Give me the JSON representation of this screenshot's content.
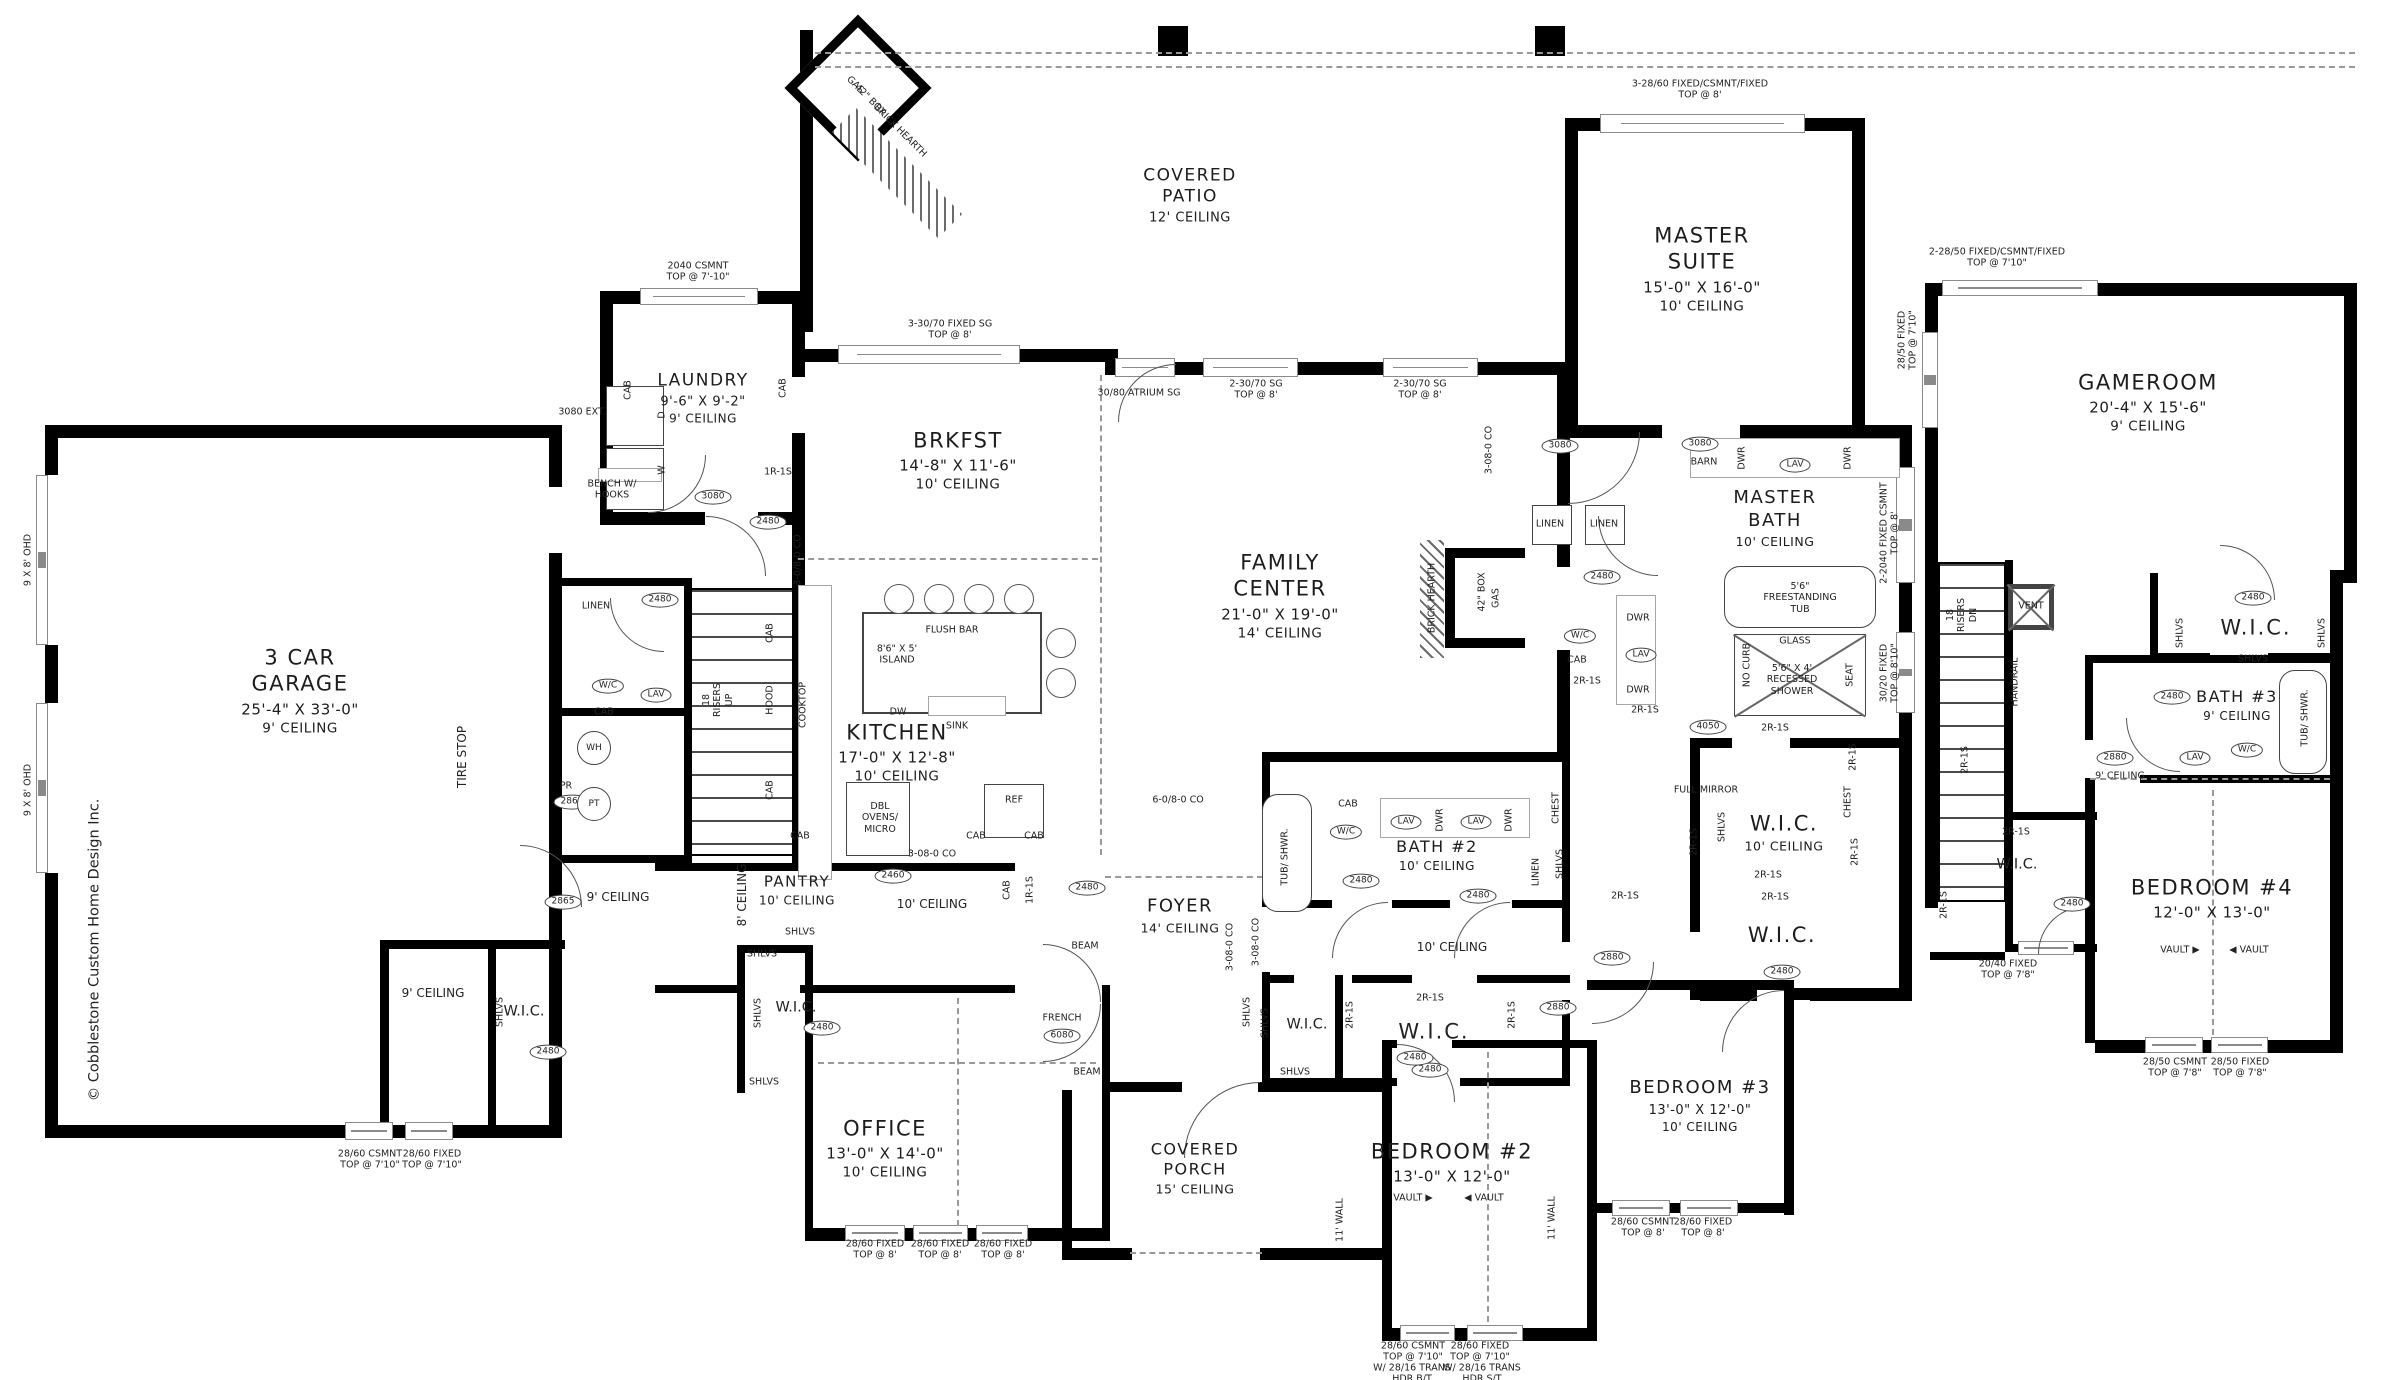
{
  "rooms": {
    "garage": {
      "name": "3 CAR\nGARAGE",
      "dims": "25'-4\" X 33'-0\"",
      "ceiling": "9' CEILING"
    },
    "laundry": {
      "name": "LAUNDRY",
      "dims": "9'-6\" X 9'-2\"",
      "ceiling": "9' CEILING"
    },
    "brkfst": {
      "name": "BRKFST",
      "dims": "14'-8\" X 11'-6\"",
      "ceiling": "10' CEILING"
    },
    "kitchen": {
      "name": "KITCHEN",
      "dims": "17'-0\" X 12'-8\"",
      "ceiling": "10' CEILING"
    },
    "family": {
      "name": "FAMILY\nCENTER",
      "dims": "21'-0\" X 19'-0\"",
      "ceiling": "14' CEILING"
    },
    "patio": {
      "name": "COVERED\nPATIO",
      "dims": "",
      "ceiling": "12' CEILING"
    },
    "master": {
      "name": "MASTER\nSUITE",
      "dims": "15'-0\" X 16'-0\"",
      "ceiling": "10' CEILING"
    },
    "masterbath": {
      "name": "MASTER\nBATH",
      "dims": "",
      "ceiling": "10' CEILING"
    },
    "masterwic": {
      "name": "W.I.C.",
      "dims": "",
      "ceiling": "10' CEILING"
    },
    "masterwic2": {
      "name": "W.I.C.",
      "dims": "",
      "ceiling": ""
    },
    "office": {
      "name": "OFFICE",
      "dims": "13'-0\" X 14'-0\"",
      "ceiling": "10' CEILING"
    },
    "foyer": {
      "name": "FOYER",
      "dims": "",
      "ceiling": "14' CEILING"
    },
    "porch": {
      "name": "COVERED\nPORCH",
      "dims": "",
      "ceiling": "15' CEILING"
    },
    "pantry": {
      "name": "PANTRY",
      "dims": "",
      "ceiling": "10' CEILING"
    },
    "bath2": {
      "name": "BATH #2",
      "dims": "",
      "ceiling": "10' CEILING"
    },
    "bed2": {
      "name": "BEDROOM #2",
      "dims": "13'-0\" X 12'-0\"",
      "ceiling": ""
    },
    "bed3": {
      "name": "BEDROOM #3",
      "dims": "13'-0\" X 12'-0\"",
      "ceiling": "10' CEILING"
    },
    "gameroom": {
      "name": "GAMEROOM",
      "dims": "20'-4\" X 15'-6\"",
      "ceiling": "9' CEILING"
    },
    "bath3": {
      "name": "BATH #3",
      "dims": "",
      "ceiling": "9' CEILING"
    },
    "bed4": {
      "name": "BEDROOM #4",
      "dims": "12'-0\" X 13'-0\"",
      "ceiling": ""
    }
  },
  "annotations": [
    {
      "t": "TIRE STOP",
      "x": 462,
      "y": 757,
      "r": -90,
      "c": "sm"
    },
    {
      "t": "© Cobblestone Custom Home Design Inc.",
      "x": 95,
      "y": 950,
      "r": -90,
      "c": "md"
    },
    {
      "t": "9 X 8' OHD",
      "x": 28,
      "y": 560,
      "r": -90
    },
    {
      "t": "9 X 8' OHD",
      "x": 28,
      "y": 790,
      "r": -90
    },
    {
      "t": "3080 EXT.",
      "x": 582,
      "y": 412
    },
    {
      "t": "2040 CSMNT\nTOP @ 7'-10\"",
      "x": 698,
      "y": 272
    },
    {
      "t": "3-30/70 FIXED SG\nTOP @ 8'",
      "x": 950,
      "y": 330
    },
    {
      "t": "30/80 ATRIUM SG",
      "x": 1139,
      "y": 393
    },
    {
      "t": "2-30/70 SG\nTOP @ 8'",
      "x": 1256,
      "y": 390
    },
    {
      "t": "2-30/70 SG\nTOP @ 8'",
      "x": 1420,
      "y": 390
    },
    {
      "t": "3-28/60 FIXED/CSMNT/FIXED\nTOP @ 8'",
      "x": 1700,
      "y": 90
    },
    {
      "t": "2-2040 FIXED CSMNT\nTOP @ 8'",
      "x": 1890,
      "y": 533,
      "r": -90
    },
    {
      "t": "30/20 FIXED\nTOP @ 8'10\"",
      "x": 1890,
      "y": 673,
      "r": -90
    },
    {
      "t": "2-28/50 FIXED/CSMNT/FIXED\nTOP @ 7'10\"",
      "x": 1997,
      "y": 258
    },
    {
      "t": "28/50 FIXED\nTOP @ 7'10\"",
      "x": 1908,
      "y": 340,
      "r": -90
    },
    {
      "t": "28/60 FIXED\nTOP @ 8'",
      "x": 875,
      "y": 1250
    },
    {
      "t": "28/60 FIXED\nTOP @ 8'",
      "x": 940,
      "y": 1250
    },
    {
      "t": "28/60 FIXED\nTOP @ 8'",
      "x": 1003,
      "y": 1250
    },
    {
      "t": "28/60 CSMNT\nTOP @ 7'10\"",
      "x": 370,
      "y": 1160
    },
    {
      "t": "28/60 FIXED\nTOP @ 7'10\"",
      "x": 432,
      "y": 1160
    },
    {
      "t": "28/60 CSMNT\nTOP @ 7'10\"",
      "x": 1413,
      "y": 1352
    },
    {
      "t": "28/60 FIXED\nTOP @ 7'10\"",
      "x": 1480,
      "y": 1352
    },
    {
      "t": "W/ 28/16 TRANS\nHDR B/T",
      "x": 1412,
      "y": 1374
    },
    {
      "t": "W/ 28/16 TRANS\nHDR S/T",
      "x": 1482,
      "y": 1374
    },
    {
      "t": "28/60 CSMNT\nTOP @ 8'",
      "x": 1643,
      "y": 1228
    },
    {
      "t": "28/60 FIXED\nTOP @ 8'",
      "x": 1703,
      "y": 1228
    },
    {
      "t": "28/50 CSMNT\nTOP @ 7'8\"",
      "x": 2175,
      "y": 1068
    },
    {
      "t": "28/50 FIXED\nTOP @ 7'8\"",
      "x": 2240,
      "y": 1068
    },
    {
      "t": "20/40 FIXED\nTOP @ 7'8\"",
      "x": 2008,
      "y": 970
    },
    {
      "t": "BENCH W/\nHOOKS",
      "x": 612,
      "y": 490
    },
    {
      "t": "1R-1S",
      "x": 778,
      "y": 472
    },
    {
      "t": "CAB",
      "x": 628,
      "y": 390,
      "r": -90
    },
    {
      "t": "CAB",
      "x": 783,
      "y": 388,
      "r": -90
    },
    {
      "t": "D",
      "x": 662,
      "y": 415,
      "r": -90
    },
    {
      "t": "W",
      "x": 662,
      "y": 470,
      "r": -90
    },
    {
      "t": "3-0/8-0 CO",
      "x": 798,
      "y": 560,
      "r": -90
    },
    {
      "t": "3080",
      "x": 713,
      "y": 497,
      "c": "ov"
    },
    {
      "t": "2480",
      "x": 768,
      "y": 522,
      "c": "ov"
    },
    {
      "t": "LINEN",
      "x": 596,
      "y": 606
    },
    {
      "t": "W/C",
      "x": 608,
      "y": 686,
      "c": "ov"
    },
    {
      "t": "LAV",
      "x": 656,
      "y": 695,
      "c": "ov"
    },
    {
      "t": "CAB",
      "x": 604,
      "y": 712
    },
    {
      "t": "2480",
      "x": 660,
      "y": 600,
      "c": "ov"
    },
    {
      "t": "PR",
      "x": 566,
      "y": 786
    },
    {
      "t": "2865",
      "x": 572,
      "y": 802,
      "c": "ov"
    },
    {
      "t": "WH",
      "x": 594,
      "y": 748,
      "c": "circ"
    },
    {
      "t": "PT",
      "x": 594,
      "y": 804,
      "c": "circ"
    },
    {
      "t": "2865",
      "x": 563,
      "y": 902,
      "c": "ov"
    },
    {
      "t": "9' CEILING",
      "x": 618,
      "y": 897,
      "c": "sm"
    },
    {
      "t": "9' CEILING",
      "x": 433,
      "y": 993,
      "c": "sm"
    },
    {
      "t": "W.I.C.",
      "x": 524,
      "y": 1012,
      "c": "md"
    },
    {
      "t": "SHLVS",
      "x": 500,
      "y": 1012,
      "r": -90
    },
    {
      "t": "2480",
      "x": 548,
      "y": 1052,
      "c": "ov"
    },
    {
      "t": "18\nRISERS\nUP",
      "x": 718,
      "y": 700,
      "r": -90
    },
    {
      "t": "FLUSH BAR",
      "x": 952,
      "y": 630
    },
    {
      "t": "8'6\" X 5'\nISLAND",
      "x": 897,
      "y": 655
    },
    {
      "t": "DW",
      "x": 898,
      "y": 712
    },
    {
      "t": "SINK",
      "x": 957,
      "y": 726
    },
    {
      "t": "HOOD",
      "x": 770,
      "y": 700,
      "r": -90
    },
    {
      "t": "COOKTOP",
      "x": 803,
      "y": 705,
      "r": -90
    },
    {
      "t": "CAB",
      "x": 770,
      "y": 633,
      "r": -90
    },
    {
      "t": "CAB",
      "x": 770,
      "y": 790,
      "r": -90
    },
    {
      "t": "CAB",
      "x": 800,
      "y": 836
    },
    {
      "t": "DBL\nOVENS/\nMICRO",
      "x": 880,
      "y": 818
    },
    {
      "t": "REF",
      "x": 1014,
      "y": 800
    },
    {
      "t": "CAB",
      "x": 976,
      "y": 836
    },
    {
      "t": "CAB",
      "x": 1034,
      "y": 836
    },
    {
      "t": "3-08-0 CO",
      "x": 932,
      "y": 854
    },
    {
      "t": "SHLVS",
      "x": 800,
      "y": 932
    },
    {
      "t": "8' CEILING",
      "x": 742,
      "y": 895,
      "r": -90,
      "c": "sm"
    },
    {
      "t": "2460",
      "x": 893,
      "y": 876,
      "c": "ov"
    },
    {
      "t": "10' CEILING",
      "x": 932,
      "y": 904,
      "c": "sm"
    },
    {
      "t": "CAB",
      "x": 1007,
      "y": 890,
      "r": -90
    },
    {
      "t": "1R-1S",
      "x": 1030,
      "y": 890,
      "r": -90
    },
    {
      "t": "2480",
      "x": 1087,
      "y": 888,
      "c": "ov"
    },
    {
      "t": "SHLVS",
      "x": 762,
      "y": 954
    },
    {
      "t": "SHLVS",
      "x": 758,
      "y": 1013,
      "r": -90
    },
    {
      "t": "SHLVS",
      "x": 764,
      "y": 1082
    },
    {
      "t": "W.I.C.",
      "x": 796,
      "y": 1008,
      "c": "md"
    },
    {
      "t": "2480",
      "x": 822,
      "y": 1028,
      "c": "ov"
    },
    {
      "t": "BEAM",
      "x": 1085,
      "y": 946
    },
    {
      "t": "BEAM",
      "x": 1087,
      "y": 1072
    },
    {
      "t": "FRENCH",
      "x": 1062,
      "y": 1018
    },
    {
      "t": "6080",
      "x": 1062,
      "y": 1036,
      "c": "ov"
    },
    {
      "t": "3-08-0 CO",
      "x": 1230,
      "y": 947,
      "r": -90
    },
    {
      "t": "SHLVS",
      "x": 1247,
      "y": 1012,
      "r": -90
    },
    {
      "t": "TUB/ SHWR.",
      "x": 1285,
      "y": 857,
      "r": -90
    },
    {
      "t": "CAB",
      "x": 1348,
      "y": 804
    },
    {
      "t": "W/C",
      "x": 1346,
      "y": 832,
      "c": "ov"
    },
    {
      "t": "LAV",
      "x": 1406,
      "y": 822,
      "c": "ov"
    },
    {
      "t": "LAV",
      "x": 1476,
      "y": 822,
      "c": "ov"
    },
    {
      "t": "DWR",
      "x": 1440,
      "y": 820,
      "r": -90
    },
    {
      "t": "DWR",
      "x": 1509,
      "y": 820,
      "r": -90
    },
    {
      "t": "LINEN",
      "x": 1536,
      "y": 872,
      "r": -90
    },
    {
      "t": "SHLVS",
      "x": 1560,
      "y": 864,
      "r": -90
    },
    {
      "t": "CHEST",
      "x": 1556,
      "y": 808,
      "r": -90
    },
    {
      "t": "2480",
      "x": 1361,
      "y": 881,
      "c": "ov"
    },
    {
      "t": "2480",
      "x": 1478,
      "y": 896,
      "c": "ov"
    },
    {
      "t": "3-08-0 CO",
      "x": 1256,
      "y": 942,
      "r": -90
    },
    {
      "t": "10' CEILING",
      "x": 1452,
      "y": 947,
      "c": "sm"
    },
    {
      "t": "2R-1S",
      "x": 1430,
      "y": 998
    },
    {
      "t": "2R-1S",
      "x": 1350,
      "y": 1015,
      "r": -90
    },
    {
      "t": "2R-1S",
      "x": 1512,
      "y": 1015,
      "r": -90
    },
    {
      "t": "W.I.C.",
      "x": 1307,
      "y": 1025,
      "c": "md"
    },
    {
      "t": "W.I.C.",
      "x": 1434,
      "y": 1032,
      "c": "lg"
    },
    {
      "t": "SHLVS",
      "x": 1265,
      "y": 1023,
      "r": -90
    },
    {
      "t": "SHLVS",
      "x": 1295,
      "y": 1072
    },
    {
      "t": "2480",
      "x": 1430,
      "y": 1070,
      "c": "ov"
    },
    {
      "t": "2880",
      "x": 1612,
      "y": 958,
      "c": "ov"
    },
    {
      "t": "2880",
      "x": 1558,
      "y": 1008,
      "c": "ov"
    },
    {
      "t": "2R-1S",
      "x": 1625,
      "y": 896
    },
    {
      "t": "VAULT ▶",
      "x": 1413,
      "y": 1198
    },
    {
      "t": "◀ VAULT",
      "x": 1484,
      "y": 1198
    },
    {
      "t": "11' WALL",
      "x": 1340,
      "y": 1220,
      "r": -90
    },
    {
      "t": "11' WALL",
      "x": 1552,
      "y": 1218,
      "r": -90
    },
    {
      "t": "2480",
      "x": 1415,
      "y": 1058,
      "c": "ov"
    },
    {
      "t": "BARN",
      "x": 1704,
      "y": 462
    },
    {
      "t": "3080",
      "x": 1700,
      "y": 444,
      "c": "ov"
    },
    {
      "t": "LAV",
      "x": 1795,
      "y": 465,
      "c": "ov"
    },
    {
      "t": "DWR",
      "x": 1742,
      "y": 458,
      "r": -90
    },
    {
      "t": "DWR",
      "x": 1848,
      "y": 458,
      "r": -90
    },
    {
      "t": "5'6\"\nFREESTANDING\nTUB",
      "x": 1800,
      "y": 598
    },
    {
      "t": "GLASS",
      "x": 1795,
      "y": 641
    },
    {
      "t": "5'6\" X 4'\nRECESSED\nSHOWER",
      "x": 1792,
      "y": 680
    },
    {
      "t": "NO CURB",
      "x": 1747,
      "y": 665,
      "r": -90
    },
    {
      "t": "SEAT",
      "x": 1850,
      "y": 675,
      "r": -90
    },
    {
      "t": "LINEN",
      "x": 1550,
      "y": 524
    },
    {
      "t": "LINEN",
      "x": 1604,
      "y": 524
    },
    {
      "t": "W/C",
      "x": 1580,
      "y": 636,
      "c": "ov"
    },
    {
      "t": "CAB",
      "x": 1577,
      "y": 660
    },
    {
      "t": "2480",
      "x": 1602,
      "y": 577,
      "c": "ov"
    },
    {
      "t": "2R-1S",
      "x": 1587,
      "y": 681
    },
    {
      "t": "2R-1S",
      "x": 1645,
      "y": 710
    },
    {
      "t": "DWR",
      "x": 1638,
      "y": 618
    },
    {
      "t": "LAV",
      "x": 1641,
      "y": 655,
      "c": "ov"
    },
    {
      "t": "DWR",
      "x": 1638,
      "y": 690
    },
    {
      "t": "42\" BOX",
      "x": 1482,
      "y": 592,
      "r": -90
    },
    {
      "t": "GAS",
      "x": 1496,
      "y": 598,
      "r": -90
    },
    {
      "t": "BRICK HEARTH",
      "x": 1432,
      "y": 598,
      "r": -90
    },
    {
      "t": "3-08-0 CO",
      "x": 1489,
      "y": 450,
      "r": -90
    },
    {
      "t": "3080",
      "x": 1560,
      "y": 446,
      "c": "ov"
    },
    {
      "t": "4050",
      "x": 1708,
      "y": 727,
      "c": "ov"
    },
    {
      "t": "2R-1S",
      "x": 1775,
      "y": 728
    },
    {
      "t": "FULL MIRROR",
      "x": 1706,
      "y": 790
    },
    {
      "t": "SHLVS",
      "x": 1722,
      "y": 827,
      "r": -90
    },
    {
      "t": "CHEST",
      "x": 1848,
      "y": 802,
      "r": -90
    },
    {
      "t": "2R-1S",
      "x": 1853,
      "y": 757,
      "r": -90
    },
    {
      "t": "2R-1S",
      "x": 1855,
      "y": 852,
      "r": -90
    },
    {
      "t": "2R-1S",
      "x": 1694,
      "y": 842,
      "r": -90
    },
    {
      "t": "2R-1S",
      "x": 1768,
      "y": 875
    },
    {
      "t": "2R-1S",
      "x": 1775,
      "y": 897
    },
    {
      "t": "2480",
      "x": 1782,
      "y": 972,
      "c": "ov"
    },
    {
      "t": "6-0/8-0 CO",
      "x": 1178,
      "y": 800
    },
    {
      "t": "GAS",
      "x": 855,
      "y": 85,
      "r": 45
    },
    {
      "t": "42\" BOX",
      "x": 870,
      "y": 100,
      "r": 45
    },
    {
      "t": "BRICK HEARTH",
      "x": 900,
      "y": 131,
      "r": 45
    },
    {
      "t": "18\nRISERS\nDN",
      "x": 1962,
      "y": 615,
      "r": -90
    },
    {
      "t": "HANDRAIL",
      "x": 2015,
      "y": 682,
      "r": -90
    },
    {
      "t": "VENT",
      "x": 2031,
      "y": 606
    },
    {
      "t": "2R-1S",
      "x": 1965,
      "y": 760,
      "r": -90
    },
    {
      "t": "2R-1S",
      "x": 1944,
      "y": 905,
      "r": -90
    },
    {
      "t": "2R-1S",
      "x": 2016,
      "y": 832
    },
    {
      "t": "W.I.C.",
      "x": 2017,
      "y": 865,
      "c": "md"
    },
    {
      "t": "2480",
      "x": 2072,
      "y": 904,
      "c": "ov"
    },
    {
      "t": "W.I.C.",
      "x": 2256,
      "y": 628,
      "c": "lg"
    },
    {
      "t": "SHLVS",
      "x": 2180,
      "y": 633,
      "r": -90
    },
    {
      "t": "SHLVS",
      "x": 2322,
      "y": 633,
      "r": -90
    },
    {
      "t": "SHLVS",
      "x": 2253,
      "y": 659
    },
    {
      "t": "2480",
      "x": 2253,
      "y": 598,
      "c": "ov"
    },
    {
      "t": "2480",
      "x": 2172,
      "y": 697,
      "c": "ov"
    },
    {
      "t": "2880",
      "x": 2115,
      "y": 758,
      "c": "ov"
    },
    {
      "t": "9' CEILING",
      "x": 2120,
      "y": 776
    },
    {
      "t": "LAV",
      "x": 2195,
      "y": 758,
      "c": "ov"
    },
    {
      "t": "W/C",
      "x": 2247,
      "y": 750,
      "c": "ov"
    },
    {
      "t": "TUB/ SHWR.",
      "x": 2305,
      "y": 718,
      "r": -90
    },
    {
      "t": "VAULT ▶",
      "x": 2180,
      "y": 950
    },
    {
      "t": "◀ VAULT",
      "x": 2249,
      "y": 950
    }
  ]
}
